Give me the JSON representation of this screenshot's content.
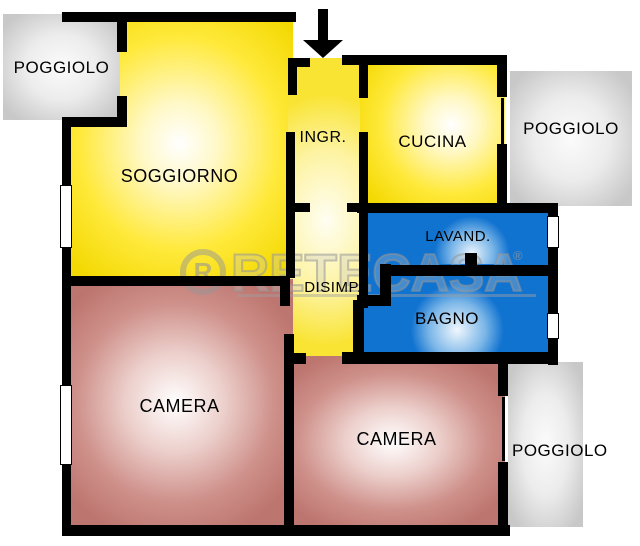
{
  "watermark": {
    "brand": "RETECASA",
    "logo_letter": "R",
    "registered_mark": "®"
  },
  "rooms": {
    "poggiolo_top_left": {
      "label": "POGGIOLO"
    },
    "soggiorno": {
      "label": "SOGGIORNO"
    },
    "ingresso": {
      "label": "INGR."
    },
    "cucina": {
      "label": "CUCINA"
    },
    "poggiolo_right": {
      "label": "POGGIOLO"
    },
    "lavanderia": {
      "label": "LAVAND."
    },
    "disimpegno": {
      "label": "DISIMP."
    },
    "bagno": {
      "label": "BAGNO"
    },
    "camera_left": {
      "label": "CAMERA"
    },
    "camera_right": {
      "label": "CAMERA"
    },
    "poggiolo_bottom_right": {
      "label": "POGGIOLO"
    }
  },
  "colors": {
    "living_zone_yellow": "#FFE93A",
    "service_zone_blue": "#1173D0",
    "bedroom_rose": "#C47E78",
    "balcony_gray": "#D9D9D9",
    "wall_black": "#000000",
    "watermark_gray": "#ADADAD"
  },
  "icons": {
    "entrance_arrow": "down-arrow"
  }
}
